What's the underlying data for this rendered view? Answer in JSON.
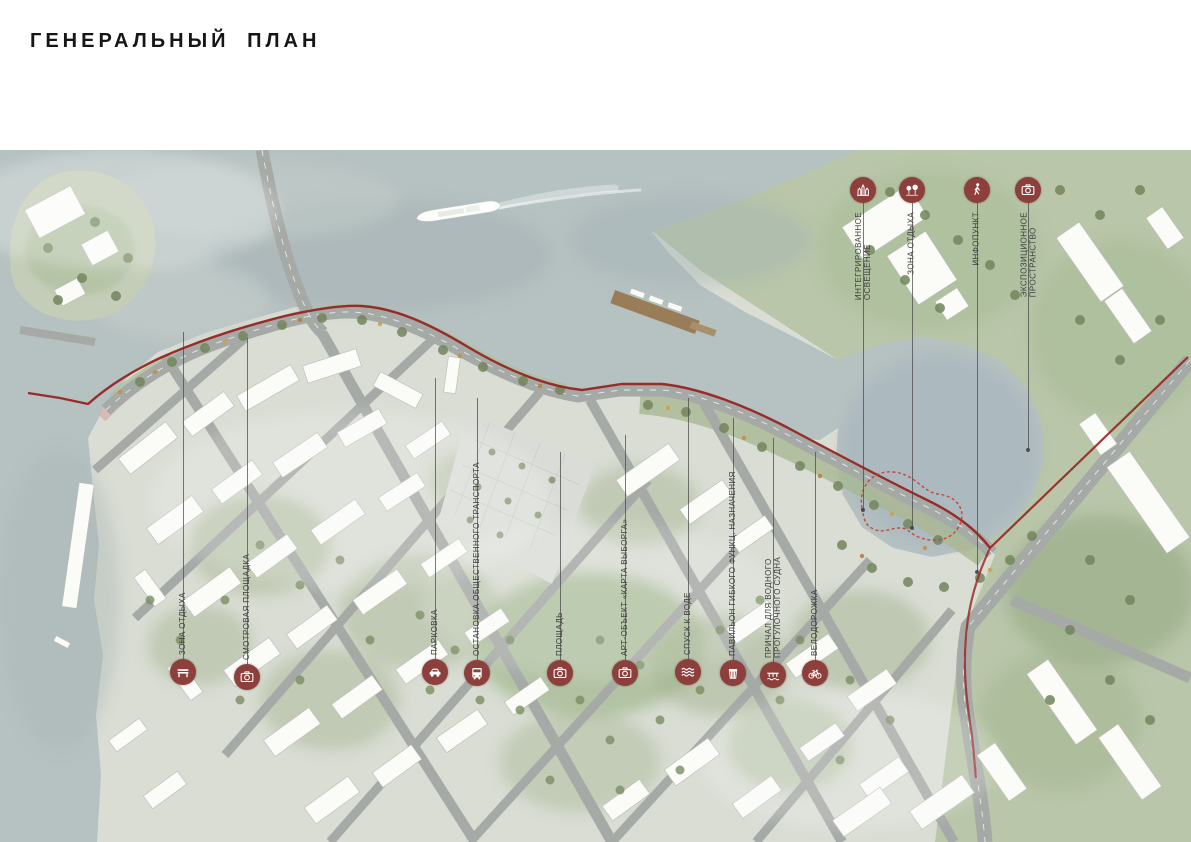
{
  "title": "ГЕНЕРАЛЬНЫЙ ПЛАН",
  "legend_markers": {
    "top": [
      {
        "icon": "castle-icon",
        "label": "ИНТЕГРИРОВАННОЕ ОСВЕЩЕНИЕ",
        "lines": [
          "ИНТЕГРИРОВАННОЕ",
          "ОСВЕЩЕНИЕ"
        ]
      },
      {
        "icon": "trees-icon",
        "label": "ЗОНА ОТДЫХА",
        "lines": [
          "ЗОНА ОТДЫХА"
        ]
      },
      {
        "icon": "pedestrian-icon",
        "label": "ИНФОПУНКТ",
        "lines": [
          "ИНФОПУНКТ"
        ]
      },
      {
        "icon": "camera-icon",
        "label": "ЭКСПОЗИЦИОННОЕ ПРОСТРАНСТВО",
        "lines": [
          "ЭКСПОЗИЦИОННОЕ",
          "ПРОСТРАНСТВО"
        ]
      }
    ],
    "bottom": [
      {
        "icon": "bench-icon",
        "label": "ЗОНА ОТДЫХА",
        "lines": [
          "ЗОНА ОТДЫХА"
        ]
      },
      {
        "icon": "camera-icon",
        "label": "СМОТРОВАЯ ПЛОЩАДКА",
        "lines": [
          "СМОТРОВАЯ ПЛОЩАДКА"
        ]
      },
      {
        "icon": "car-icon",
        "label": "ПАРКОВКА",
        "lines": [
          "ПАРКОВКА"
        ]
      },
      {
        "icon": "bus-icon",
        "label": "ОСТАНОВКА ОБЩЕСТВЕННОГО ТРАНСПОРТА",
        "lines": [
          "ОСТАНОВКА ОБЩЕСТВЕННОГО ТРАНСПОРТА"
        ]
      },
      {
        "icon": "camera-icon",
        "label": "ПЛОЩАДЬ",
        "lines": [
          "ПЛОЩАДЬ"
        ]
      },
      {
        "icon": "camera-icon",
        "label": "АРТ-ОБЪЕКТ «КАРТА ВЫБОРГА»",
        "lines": [
          "АРТ-ОБЪЕКТ «КАРТА ВЫБОРГА»"
        ]
      },
      {
        "icon": "waves-icon",
        "label": "СПУСК К ВОДЕ",
        "lines": [
          "СПУСК К ВОДЕ"
        ]
      },
      {
        "icon": "kiosk-icon",
        "label": "ПАВИЛЬОН ГИБКОГО ФУНКЦ. НАЗНАЧЕНИЯ",
        "lines": [
          "ПАВИЛЬОН ГИБКОГО ФУНКЦ. НАЗНАЧЕНИЯ"
        ]
      },
      {
        "icon": "pier-icon",
        "label": "ПРИЧАЛ ДЛЯ ВОДНОГО ПРОГУЛОЧНОГО СУДНА",
        "lines": [
          "ПРИЧАЛ ДЛЯ ВОДНОГО",
          "ПРОГУЛОЧНОГО СУДНА"
        ]
      },
      {
        "icon": "bicycle-icon",
        "label": "ВЕЛОДОРОЖКА",
        "lines": [
          "ВЕЛОДОРОЖКА"
        ]
      }
    ]
  },
  "map": {
    "landmarks": [
      "ship",
      "pier",
      "island",
      "round-bay",
      "red-embankment-route",
      "central-plaza"
    ],
    "colors": {
      "water": "#b6c1c1",
      "land": "#d9ddd4",
      "park_green": "#b9c6a9",
      "promenade": "#d7b3aa",
      "route_red": "#962521",
      "marker": "#8d3f3c"
    }
  }
}
